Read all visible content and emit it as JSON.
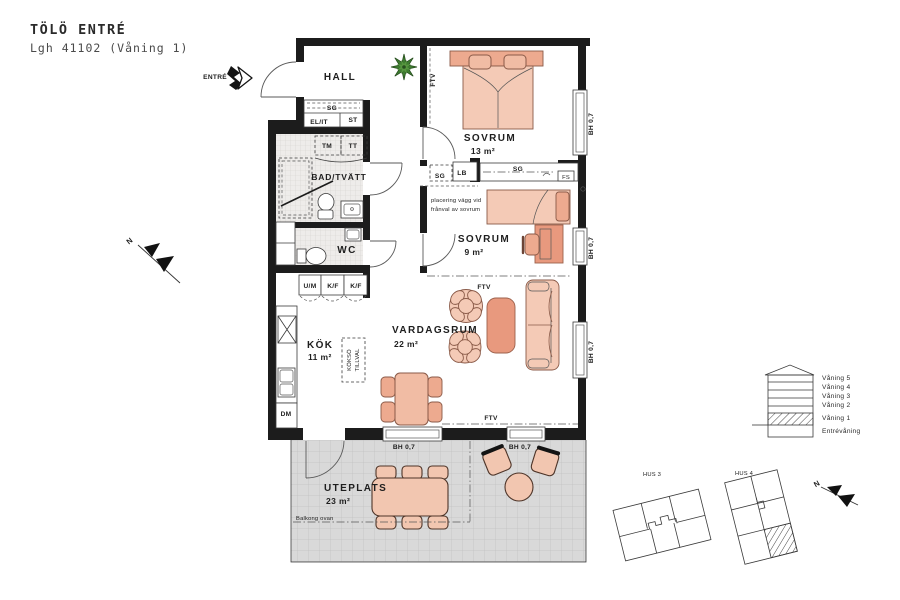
{
  "header": {
    "title": "TÖLÖ ENTRÉ",
    "subtitle": "Lgh 41102 (Våning 1)"
  },
  "labels": {
    "entre": "ENTRÉ",
    "hall": "HALL",
    "bad": "BAD/TVÄTT",
    "wc": "WC",
    "kok": "KÖK",
    "kok_area": "11 m²",
    "vardagsrum": "VARDAGSRUM",
    "vardagsrum_area": "22 m²",
    "sovrum": "SOVRUM",
    "sovrum13_area": "13 m²",
    "sovrum9_area": "9 m²",
    "uteplats": "UTEPLATS",
    "uteplats_area": "23 m²",
    "balkong": "Balkong ovan",
    "placering_1": "placering vägg vid",
    "placering_2": "frånval av sovrum",
    "kokso_1": "KÖKSÖ",
    "kokso_2": "TILLVAL"
  },
  "fixtures": {
    "sg": "SG",
    "elit": "EL/IT",
    "st": "ST",
    "tm": "TM",
    "tt": "TT",
    "lb": "LB",
    "fs": "FS",
    "um": "U/M",
    "kf": "K/F",
    "dm": "DM",
    "ftv": "FTV",
    "bh": "BH 0,7"
  },
  "compass": {
    "north": "N"
  },
  "legend": {
    "floors": [
      "Våning 5",
      "Våning 4",
      "Våning 3",
      "Våning 2",
      "Våning 1",
      "Entrévåning"
    ],
    "hus3": "HUS 3",
    "hus4": "HUS 4"
  },
  "colors": {
    "wall": "#1c1c1c",
    "furniture_light": "#f4cab6",
    "furniture_mid": "#edaa8f",
    "furniture_dark": "#e8997e",
    "plant_green": "#3e7d30",
    "tile": "#eeecea",
    "patio": "#d9d9d9"
  }
}
